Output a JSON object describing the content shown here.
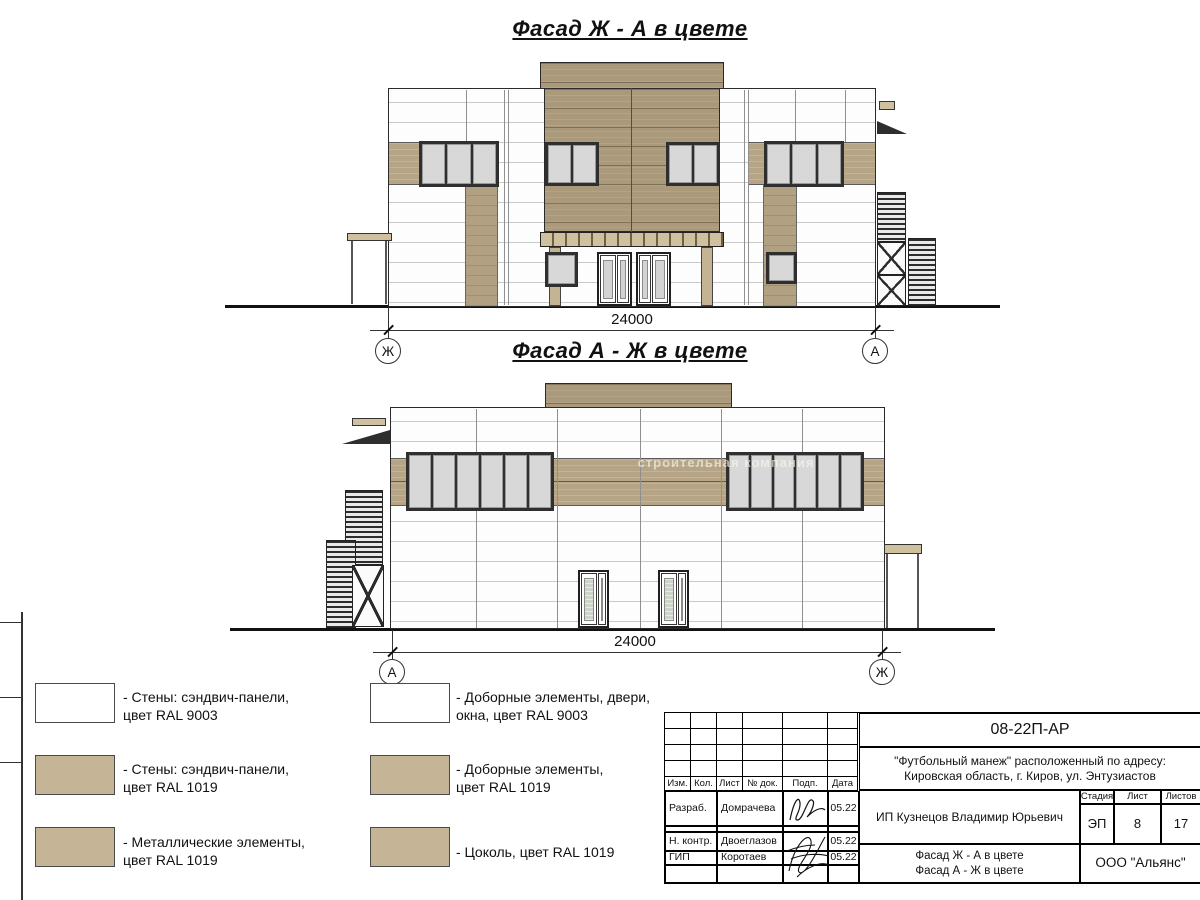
{
  "colors": {
    "wall_white": "#fdfdfd",
    "panel_tan": "#aa997b",
    "band_tan": "#b5a486",
    "swatch_tan": "#c5b496",
    "line_dark": "#2a2a2a"
  },
  "facade1": {
    "title": "Фасад Ж - А в цвете",
    "dimension": "24000",
    "axis_left": "Ж",
    "axis_right": "А"
  },
  "facade2": {
    "title": "Фасад А - Ж в цвете",
    "dimension": "24000",
    "axis_left": "А",
    "axis_right": "Ж"
  },
  "watermark": {
    "text": "строительная компания"
  },
  "legend": {
    "items": [
      {
        "swatch": "#ffffff",
        "line1": "- Стены: сэндвич-панели,",
        "line2": "цвет RAL 9003"
      },
      {
        "swatch": "#c5b496",
        "line1": "- Стены: сэндвич-панели,",
        "line2": "цвет RAL 1019"
      },
      {
        "swatch": "#c5b496",
        "line1": "- Металлические элементы,",
        "line2": "цвет RAL 1019"
      },
      {
        "swatch": "#ffffff",
        "line1": "- Доборные элементы, двери,",
        "line2": "окна, цвет RAL 9003"
      },
      {
        "swatch": "#c5b496",
        "line1": "- Доборные элементы,",
        "line2": "цвет RAL 1019"
      },
      {
        "swatch": "#c5b496",
        "line1": "- Цоколь, цвет RAL 1019",
        "line2": ""
      }
    ]
  },
  "titleblock": {
    "doc_number": "08-22П-АР",
    "project_line1": "\"Футбольный манеж\" расположенный по адресу:",
    "project_line2": "Кировская область, г. Киров, ул. Энтузиастов",
    "header_cols": [
      "Изм.",
      "Кол.",
      "Лист",
      "№ док.",
      "Подп.",
      "Дата"
    ],
    "rows": [
      {
        "role": "Разраб.",
        "name": "Домрачева",
        "date": "05.22"
      },
      {
        "role": "Н. контр.",
        "name": "Двоеглазов",
        "date": "05.22"
      },
      {
        "role": "ГИП",
        "name": "Коротаев",
        "date": "05.22"
      }
    ],
    "client": "ИП Кузнецов Владимир Юрьевич",
    "stage_label": "Стадия",
    "sheet_label": "Лист",
    "sheets_label": "Листов",
    "stage": "ЭП",
    "sheet": "8",
    "sheets": "17",
    "drawing_title_line1": "Фасад Ж - А в цвете",
    "drawing_title_line2": "Фасад А - Ж в цвете",
    "company": "ООО \"Альянс\""
  }
}
